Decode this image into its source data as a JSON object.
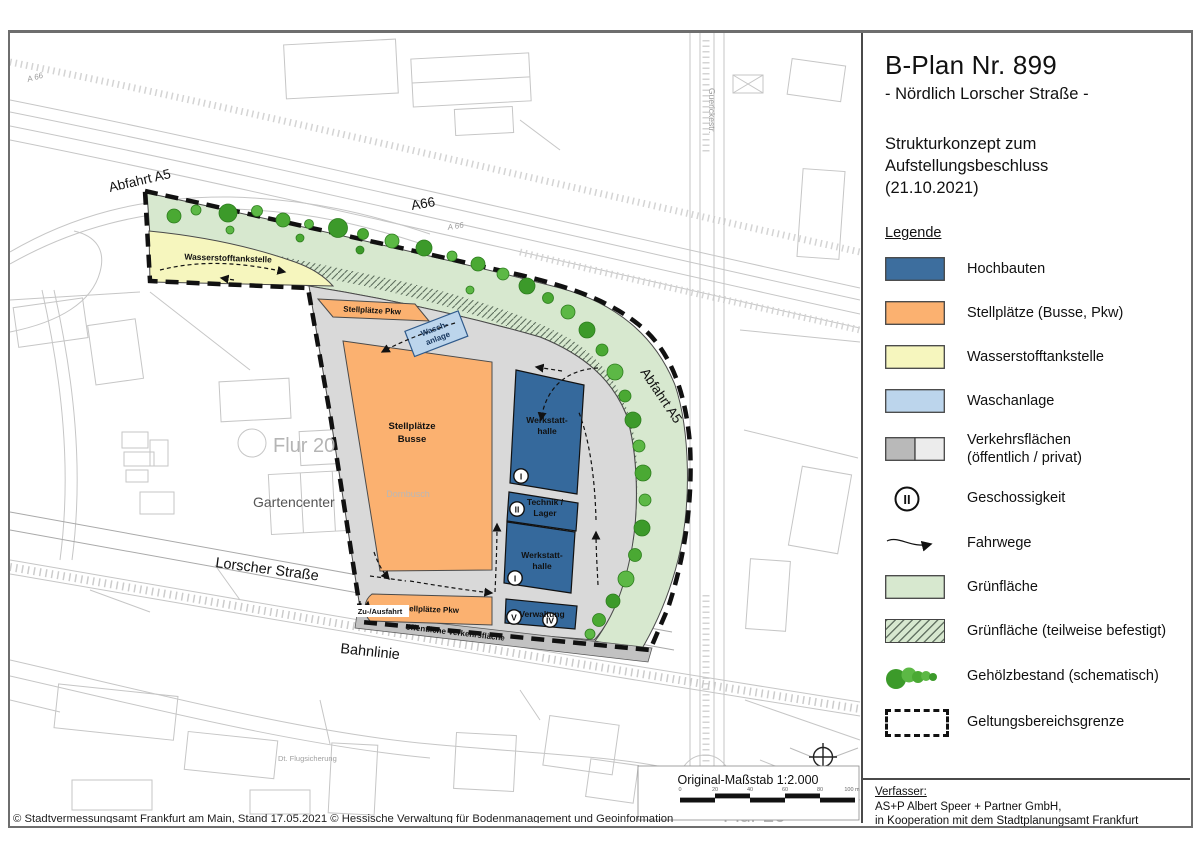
{
  "title_block": {
    "title": "B-Plan Nr. 899",
    "subtitle": "- Nördlich Lorscher Straße -",
    "concept": "Strukturkonzept zum Aufstellungsbeschluss (21.10.2021)"
  },
  "legend": {
    "heading": "Legende",
    "items": [
      {
        "label": "Hochbauten",
        "color": "#3D6E9E"
      },
      {
        "label": "Stellplätze (Busse, Pkw)",
        "color": "#FBB170"
      },
      {
        "label": "Wasserstofftankstelle",
        "color": "#F6F6BE"
      },
      {
        "label": "Waschanlage",
        "color": "#BCD5EC"
      },
      {
        "label": "Verkehrsflächen",
        "label2": "(öffentlich / privat)",
        "color_public": "#B9B9B9",
        "color_private": "#ECECEC"
      },
      {
        "label": "Geschossigkeit",
        "symbol": "II"
      },
      {
        "label": "Fahrwege"
      },
      {
        "label": "Grünfläche",
        "color": "#D7E8CF"
      },
      {
        "label": "Grünfläche (teilweise befestigt)",
        "color": "#D7E8CF"
      },
      {
        "label": "Gehölzbestand (schematisch)",
        "color": "#46A837"
      },
      {
        "label": "Geltungsbereichsgrenze"
      }
    ]
  },
  "author_block": {
    "heading": "Verfasser:",
    "line1": "AS+P Albert Speer + Partner GmbH,",
    "line2": "in Kooperation mit dem Stadtplanungsamt Frankfurt"
  },
  "map": {
    "labels": {
      "abfahrt_a5_left": "Abfahrt A5",
      "a66": "A66",
      "a66_small_left": "A 66",
      "a66_small_mid": "A 66",
      "abfahrt_a5_right": "Abfahrt A5",
      "wasserstofftankstelle": "Wasserstofftankstelle",
      "stellplaetze_pkw_top": "Stellplätze Pkw",
      "wasch_l1": "Wasch-",
      "wasch_l2": "anlage",
      "busse_l1": "Stellplätze",
      "busse_l2": "Busse",
      "dornbusch": "Dornbusch",
      "werkstatt_l1": "Werkstatt-",
      "werkstatt_l2": "halle",
      "technik_l1": "Technik /",
      "technik_l2": "Lager",
      "verwaltung": "Verwaltung",
      "stellplaetze_pkw_bottom": "Stellplätze Pkw",
      "zu_ausfahrt": "Zu-/Ausfahrt",
      "oeff_verkehr": "öffentliche Verkehrsfläche",
      "lorscher_strasse": "Lorscher Straße",
      "bahnlinie": "Bahnlinie",
      "flur_20": "Flur 20",
      "flur_26": "Flur 26",
      "gartencenter": "Gartencenter",
      "flugsicherung": "Dt. Flugsicherung",
      "guerickestr": "Guerickestr."
    },
    "storeys": {
      "w1": "I",
      "technik": "II",
      "w2": "I",
      "verw_a": "V",
      "verw_b": "IV"
    },
    "scale": {
      "label": "Original-Maßstab 1:2.000",
      "ticks": [
        "0",
        "20",
        "40",
        "60",
        "80",
        "100 m"
      ]
    },
    "copyright": "© Stadtvermessungsamt Frankfurt am Main, Stand 17.05.2021 © Hessische Verwaltung für Bodenmanagement und Geoinformation"
  }
}
